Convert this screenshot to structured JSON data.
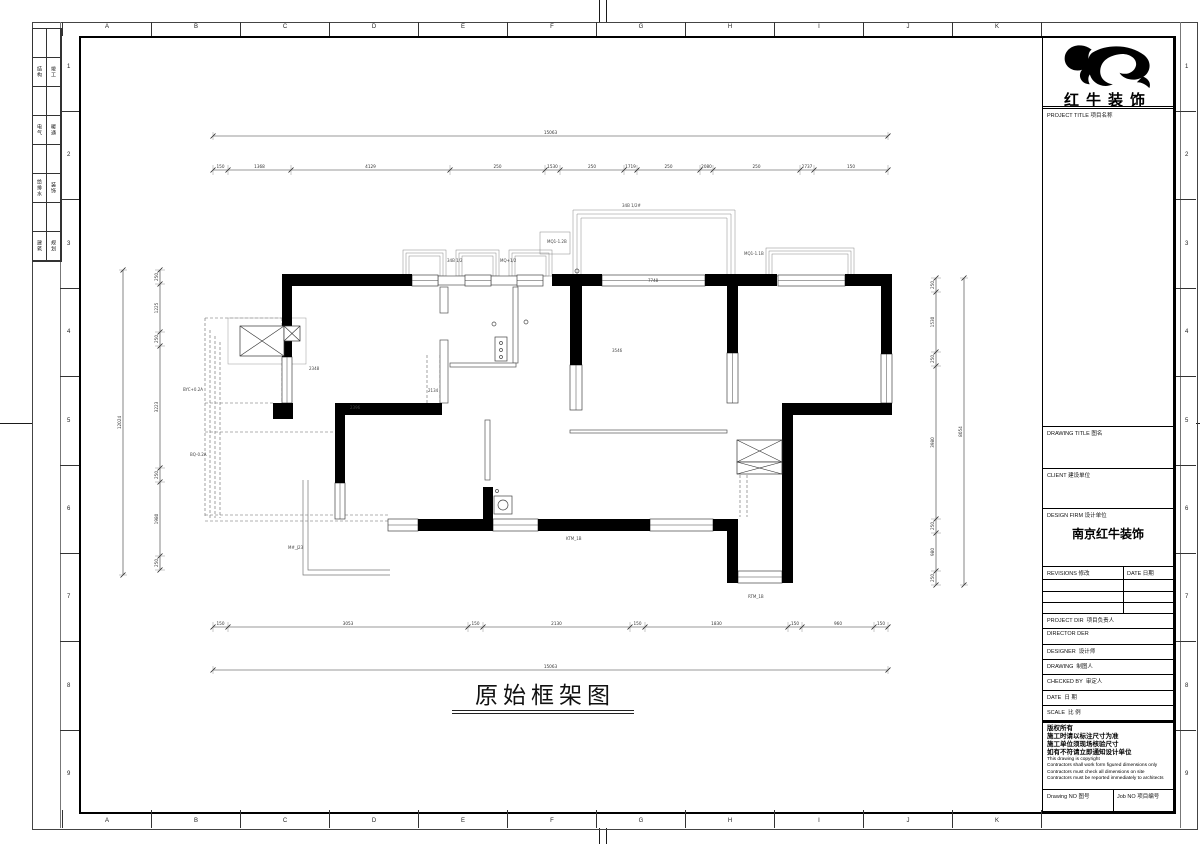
{
  "sheet": {
    "grid_letters": [
      "A",
      "B",
      "C",
      "D",
      "E",
      "F",
      "G",
      "H",
      "I",
      "J",
      "K"
    ],
    "grid_numbers": [
      "1",
      "2",
      "3",
      "4",
      "5",
      "6",
      "7",
      "8",
      "9"
    ],
    "signoff_rows": [
      [
        "结构",
        "竣工"
      ],
      [
        "电气",
        "暖通"
      ],
      [
        "给排水",
        "装饰"
      ],
      [
        "建筑",
        "规划"
      ]
    ]
  },
  "plan": {
    "title": "原始框架图",
    "walls": [
      [
        282,
        274,
        130,
        12
      ],
      [
        552,
        274,
        50,
        12
      ],
      [
        705,
        274,
        72,
        12
      ],
      [
        845,
        274,
        47,
        12
      ],
      [
        881,
        274,
        11,
        80
      ],
      [
        282,
        285,
        10,
        72
      ],
      [
        273,
        403,
        20,
        16
      ],
      [
        570,
        274,
        12,
        91
      ],
      [
        727,
        276,
        11,
        77
      ],
      [
        782,
        403,
        110,
        12
      ],
      [
        782,
        415,
        11,
        168
      ],
      [
        727,
        519,
        11,
        64
      ],
      [
        713,
        519,
        25,
        12
      ],
      [
        418,
        519,
        75,
        12
      ],
      [
        538,
        519,
        112,
        12
      ],
      [
        335,
        403,
        10,
        80
      ],
      [
        337,
        403,
        105,
        12
      ],
      [
        483,
        487,
        10,
        33
      ]
    ],
    "thin_walls": [
      [
        440,
        287,
        8,
        26
      ],
      [
        440,
        340,
        8,
        63
      ],
      [
        513,
        287,
        5,
        76
      ],
      [
        450,
        363,
        66,
        4
      ],
      [
        485,
        420,
        5,
        60
      ],
      [
        570,
        430,
        157,
        3
      ],
      [
        438,
        276,
        29,
        9
      ],
      [
        491,
        276,
        28,
        9
      ]
    ],
    "windows": [
      [
        412,
        275,
        26,
        11
      ],
      [
        465,
        275,
        26,
        11
      ],
      [
        517,
        275,
        26,
        11
      ],
      [
        602,
        275,
        103,
        11
      ],
      [
        778,
        275,
        67,
        11
      ],
      [
        881,
        354,
        11,
        49
      ],
      [
        727,
        353,
        11,
        50
      ],
      [
        570,
        365,
        12,
        45
      ],
      [
        738,
        571,
        44,
        12
      ],
      [
        650,
        519,
        63,
        12
      ],
      [
        493,
        519,
        45,
        12
      ],
      [
        388,
        519,
        30,
        12
      ],
      [
        282,
        357,
        10,
        46
      ],
      [
        335,
        483,
        10,
        36
      ]
    ],
    "bays": [
      [
        403,
        250,
        43,
        26
      ],
      [
        456,
        250,
        43,
        26
      ],
      [
        509,
        250,
        43,
        26
      ],
      [
        766,
        248,
        88,
        28
      ]
    ],
    "terrace": {
      "x": 573,
      "y": 210,
      "w": 162,
      "h": 66,
      "step": [
        540,
        232,
        30,
        22
      ]
    },
    "light_rects": [
      [
        228,
        318,
        78,
        46
      ]
    ],
    "xboxes": [
      [
        240,
        326,
        44,
        30
      ],
      [
        284,
        326,
        16,
        15
      ],
      [
        737,
        440,
        45,
        22
      ],
      [
        737,
        462,
        45,
        12
      ]
    ],
    "dashes": [
      [
        205,
        318,
        205,
        518
      ],
      [
        210,
        330,
        210,
        518
      ],
      [
        215,
        336,
        215,
        518
      ],
      [
        220,
        342,
        220,
        518
      ],
      [
        282,
        318,
        282,
        403
      ],
      [
        205,
        318,
        282,
        318
      ],
      [
        205,
        403,
        273,
        403
      ],
      [
        205,
        432,
        335,
        432
      ],
      [
        205,
        515,
        390,
        515
      ],
      [
        205,
        521,
        390,
        521
      ],
      [
        427,
        355,
        427,
        403
      ],
      [
        440,
        355,
        440,
        403
      ],
      [
        740,
        475,
        740,
        517
      ],
      [
        747,
        475,
        747,
        517
      ]
    ],
    "lshape": {
      "outer": [
        303,
        480,
        303,
        575,
        390,
        575
      ],
      "inner": [
        308,
        480,
        308,
        570,
        390,
        570
      ]
    },
    "fixtures": {
      "circles": [
        [
          494,
          324,
          2
        ],
        [
          526,
          322,
          2
        ],
        [
          503,
          505,
          5
        ],
        [
          501,
          343,
          1.5
        ],
        [
          501,
          350,
          1.5
        ],
        [
          501,
          357,
          1.5
        ],
        [
          577,
          271,
          2
        ],
        [
          497,
          491,
          1.5
        ]
      ],
      "rects": [
        [
          495,
          337,
          12,
          24
        ],
        [
          494,
          496,
          18,
          18
        ]
      ]
    },
    "labels": [
      {
        "t": "34B 1/2#",
        "x": 622,
        "y": 207
      },
      {
        "t": "MQ1-1.2B",
        "x": 547,
        "y": 243
      },
      {
        "t": "7748",
        "x": 648,
        "y": 282
      },
      {
        "t": "MQ1-1.1B",
        "x": 744,
        "y": 255
      },
      {
        "t": "34B 1/2",
        "x": 447,
        "y": 262
      },
      {
        "t": "MQ+1/2",
        "x": 500,
        "y": 262
      },
      {
        "t": "BYC+0.2A",
        "x": 183,
        "y": 391
      },
      {
        "t": "BQ-0.2A",
        "x": 190,
        "y": 456
      },
      {
        "t": "2348",
        "x": 309,
        "y": 370
      },
      {
        "t": "2396",
        "x": 350,
        "y": 409
      },
      {
        "t": "2134",
        "x": 428,
        "y": 392
      },
      {
        "t": "3546",
        "x": 612,
        "y": 352
      },
      {
        "t": "KTM_1B",
        "x": 566,
        "y": 540
      },
      {
        "t": "M#_J23",
        "x": 288,
        "y": 549
      },
      {
        "t": "RTM_1B",
        "x": 748,
        "y": 598
      }
    ],
    "dims": {
      "h_chains": [
        {
          "y": 170,
          "ticks": [
            213,
            228,
            291,
            450,
            545,
            560,
            624,
            637,
            700,
            713,
            800,
            814,
            888
          ],
          "labels": [
            "150",
            "1368",
            "4129",
            "250",
            "1530",
            "250",
            "1719",
            "250",
            "2080",
            "250",
            "2737",
            "150"
          ]
        },
        {
          "y": 627,
          "ticks": [
            213,
            228,
            468,
            483,
            630,
            645,
            788,
            802,
            874,
            888
          ],
          "labels": [
            "150",
            "3053",
            "150",
            "2130",
            "150",
            "1830",
            "150",
            "960",
            "150"
          ]
        }
      ],
      "v_chains": [
        {
          "x": 160,
          "ticks": [
            270,
            284,
            332,
            346,
            468,
            482,
            556,
            570
          ],
          "labels": [
            "250",
            "1225",
            "250",
            "3223",
            "250",
            "1980",
            "250"
          ]
        },
        {
          "x": 936,
          "ticks": [
            278,
            292,
            352,
            366,
            519,
            533,
            571,
            585
          ],
          "labels": [
            "250",
            "1530",
            "250",
            "3980",
            "250",
            "980",
            "250"
          ]
        }
      ],
      "h_overalls": [
        {
          "y": 136,
          "x1": 213,
          "x2": 888,
          "label": "15063"
        },
        {
          "y": 670,
          "x1": 213,
          "x2": 888,
          "label": "15063"
        }
      ],
      "v_overalls": [
        {
          "x": 123,
          "y1": 270,
          "y2": 575,
          "label": "12024"
        },
        {
          "x": 964,
          "y1": 278,
          "y2": 585,
          "label": "8054"
        }
      ]
    }
  },
  "title_block": {
    "logo_text": "红牛装饰",
    "project_title": {
      "en": "PROJECT TITLE",
      "cn": "项目名称"
    },
    "drawing_title": {
      "en": "DRAWING TITLE",
      "cn": "图名"
    },
    "client": {
      "en": "CLIENT",
      "cn": "建设单位"
    },
    "design_firm": {
      "en": "DESIGN FIRM",
      "cn": "设计单位",
      "value": "南京红牛装饰"
    },
    "revisions": {
      "en": "REVISIONS",
      "cn": "修改",
      "date_en": "DATE",
      "date_cn": "日期"
    },
    "rows": [
      {
        "en": "PROJECT DIR",
        "cn": "项目负责人"
      },
      {
        "en": "DIRECTOR DER",
        "cn": ""
      },
      {
        "en": "DESIGNER",
        "cn": "设计师"
      },
      {
        "en": "DRAWING",
        "cn": "制图人"
      },
      {
        "en": "CHECKED BY",
        "cn": "审定人"
      },
      {
        "en": "DATE",
        "cn": "日 期"
      },
      {
        "en": "SCALE",
        "cn": "比 例"
      }
    ],
    "notes_cn": [
      "版权所有",
      "施工时请以标注尺寸为准",
      "施工单位须现场核验尺寸",
      "如有不符请立即通知设计单位"
    ],
    "notes_en": [
      "This drawing is copyright",
      "Contractors shall work form figured dimensions only",
      "Contractors must check all dimensions on site",
      "Contractors must be reported immediately to architects"
    ],
    "drawing_no": {
      "en": "Drawing NO",
      "cn": "图号"
    },
    "job_no": {
      "en": "Job NO",
      "cn": "项目编号"
    }
  }
}
